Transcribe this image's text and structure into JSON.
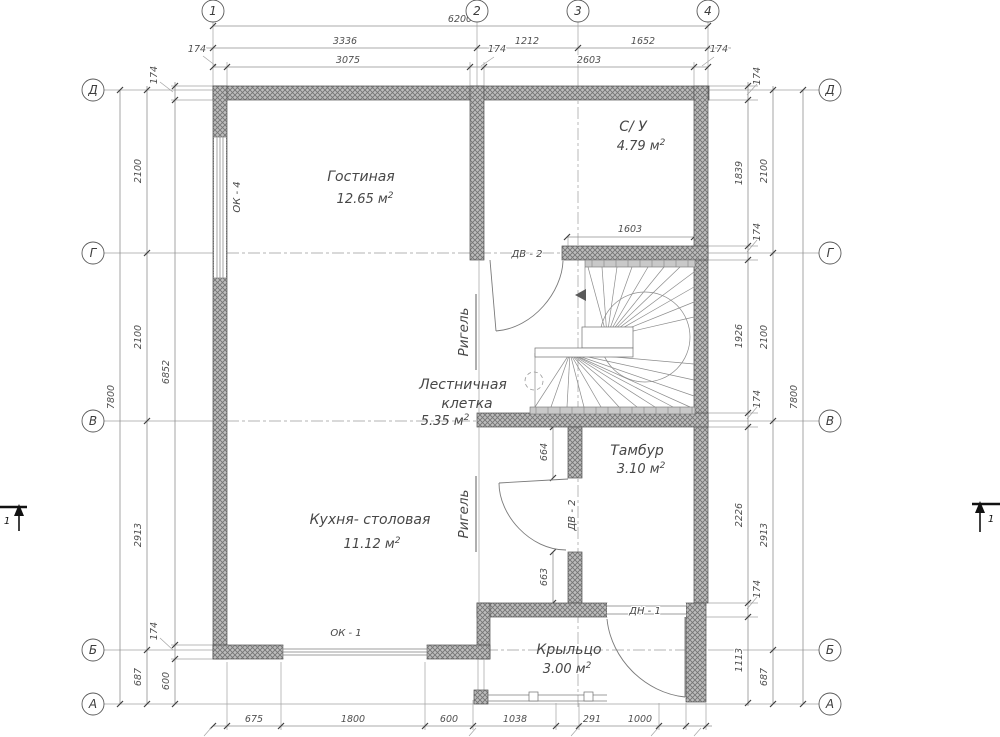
{
  "axes": {
    "top": [
      "1",
      "2",
      "3",
      "4"
    ],
    "side": [
      "Д",
      "Г",
      "В",
      "Б",
      "А"
    ]
  },
  "dims": {
    "wall": "174",
    "top_total": "6200",
    "top_spans": [
      "3336",
      "1212",
      "1652"
    ],
    "top_inner": [
      "3075",
      "2603"
    ],
    "bottom": [
      "675",
      "1800",
      "600",
      "1038",
      "291",
      "1000"
    ],
    "side_outer": "7800",
    "side_spans": [
      "2100",
      "2100",
      "2913",
      "687"
    ],
    "left_inner": [
      "6852",
      "600"
    ],
    "right_inner": [
      "1839",
      "1926",
      "2226",
      "1113"
    ],
    "su_width": "1603",
    "door_off_top": "664",
    "door_off_bottom": "663"
  },
  "rooms": {
    "living": {
      "name": "Гостиная",
      "area": "12.65  м",
      "sup": "2"
    },
    "wc": {
      "name": "С/ У",
      "area": "4.79  м",
      "sup": "2"
    },
    "stairwell": {
      "line1": "Лестничная",
      "line2": "клетка",
      "area": "5.35  м",
      "sup": "2"
    },
    "kitchen": {
      "name": "Кухня- столовая",
      "area": "11.12  м",
      "sup": "2"
    },
    "tambour": {
      "name": "Тамбур",
      "area": "3.10  м",
      "sup": "2"
    },
    "porch": {
      "name": "Крыльцо",
      "area": "3.00  м",
      "sup": "2"
    }
  },
  "openings": {
    "ok4": "ОК - 4",
    "ok1": "ОК - 1",
    "dv2": "ДВ - 2",
    "dn1": "ДН - 1"
  },
  "beam": "Ригель",
  "section": "1",
  "colors": {
    "line": "#8f8f8f",
    "wall_hatch": "#757575",
    "text": "#4f4f4f",
    "background": "#ffffff"
  }
}
